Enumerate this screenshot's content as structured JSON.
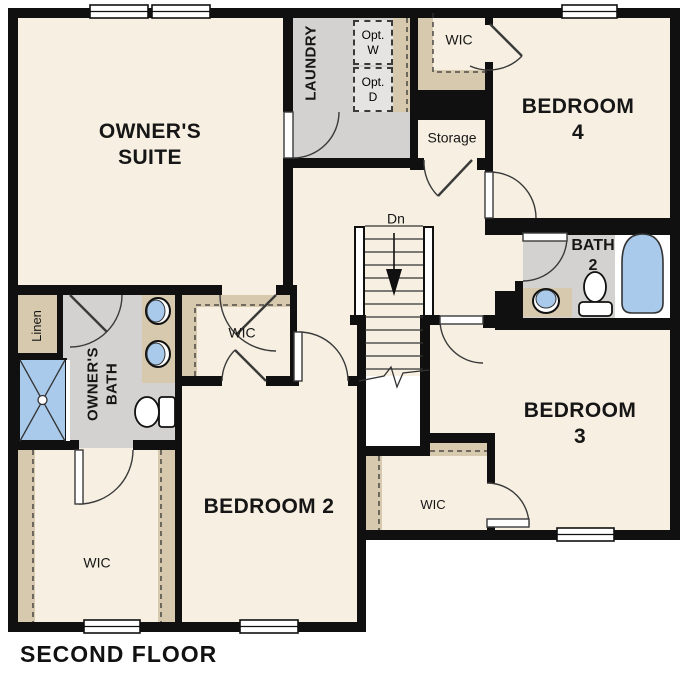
{
  "floor_plan": {
    "caption": "SECOND FLOOR",
    "rooms": {
      "owners_suite": "OWNER'S\nSUITE",
      "laundry": "LAUNDRY",
      "opt_washer": "Opt.\nW",
      "opt_dryer": "Opt.\nD",
      "wic_laundry": "WIC",
      "storage": "Storage",
      "bedroom4": "BEDROOM 4",
      "bath2": "BATH\n2",
      "stairs_dn": "Dn",
      "linen": "Linen",
      "owners_bath": "OWNER'S\nBATH",
      "wic_bedroom2": "WIC",
      "owners_wic": "WIC",
      "bedroom2": "BEDROOM 2",
      "wic_bedroom3": "WIC",
      "bedroom3": "BEDROOM 3"
    },
    "colors": {
      "wall": "#101010",
      "floor": "#F7F0E2",
      "tile": "#D3D2D0",
      "tan": "#D6C9AE",
      "fixture": "#A9CAEB",
      "appliance": "#E5E4E2"
    }
  }
}
